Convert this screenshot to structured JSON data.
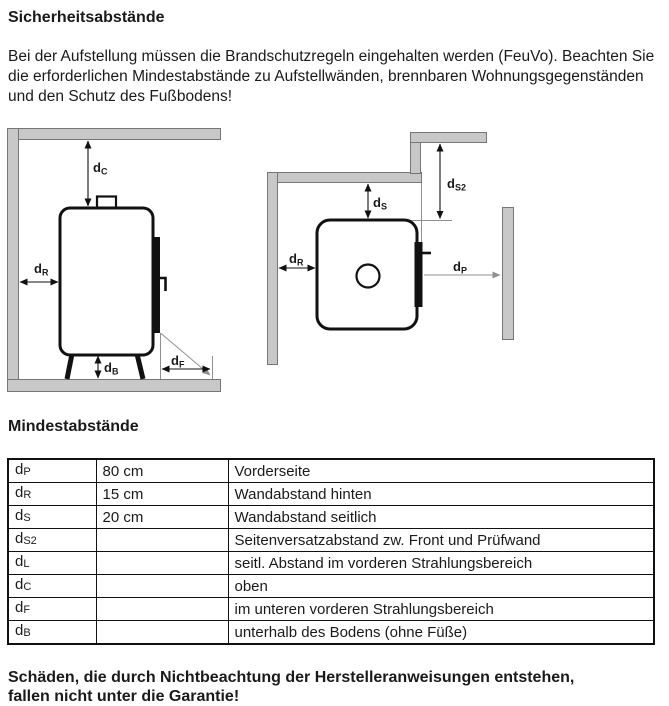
{
  "page": {
    "title": "Sicherheitsabstände",
    "intro": "Bei der Aufstellung müssen die Brandschutzregeln eingehalten werden (FeuVo). Beachten Sie die erforderlichen Mindestabstände zu Aufstellwänden, brennbaren Wohnungsgegenständen und den Schutz des Fußbodens!",
    "section_heading": "Mindestabstände",
    "warning_line1": "Schäden, die durch Nichtbeachtung der Herstelleranweisungen entstehen,",
    "warning_line2": "fallen nicht unter die Garantie!"
  },
  "colors": {
    "text": "#1a1a1a",
    "wall_fill": "#c8c8c8",
    "wall_border": "#767676",
    "line": "#111111",
    "witness": "#909090",
    "bg": "#ffffff"
  },
  "diagrams": {
    "side_view": {
      "labels": {
        "dC": {
          "base": "d",
          "sub": "C"
        },
        "dR": {
          "base": "d",
          "sub": "R"
        },
        "dB": {
          "base": "d",
          "sub": "B"
        },
        "dF": {
          "base": "d",
          "sub": "F"
        }
      }
    },
    "top_view": {
      "labels": {
        "dS": {
          "base": "d",
          "sub": "S"
        },
        "dS2": {
          "base": "d",
          "sub": "S2"
        },
        "dR": {
          "base": "d",
          "sub": "R"
        },
        "dP": {
          "base": "d",
          "sub": "P"
        }
      }
    }
  },
  "table": {
    "rows": [
      {
        "sym": "d",
        "sub": "P",
        "value": "80 cm",
        "desc": "Vorderseite"
      },
      {
        "sym": "d",
        "sub": "R",
        "value": "15 cm",
        "desc": "Wandabstand hinten"
      },
      {
        "sym": "d",
        "sub": "S",
        "value": "20 cm",
        "desc": "Wandabstand seitlich"
      },
      {
        "sym": "d",
        "sub": "S2",
        "value": "",
        "desc": "Seitenversatzabstand zw. Front und Prüfwand"
      },
      {
        "sym": "d",
        "sub": "L",
        "value": "",
        "desc": "seitl. Abstand im vorderen Strahlungsbereich"
      },
      {
        "sym": "d",
        "sub": "C",
        "value": "",
        "desc": "oben"
      },
      {
        "sym": "d",
        "sub": "F",
        "value": "",
        "desc": "im unteren vorderen Strahlungsbereich"
      },
      {
        "sym": "d",
        "sub": "B",
        "value": "",
        "desc": "unterhalb des Bodens (ohne Füße)"
      }
    ]
  }
}
